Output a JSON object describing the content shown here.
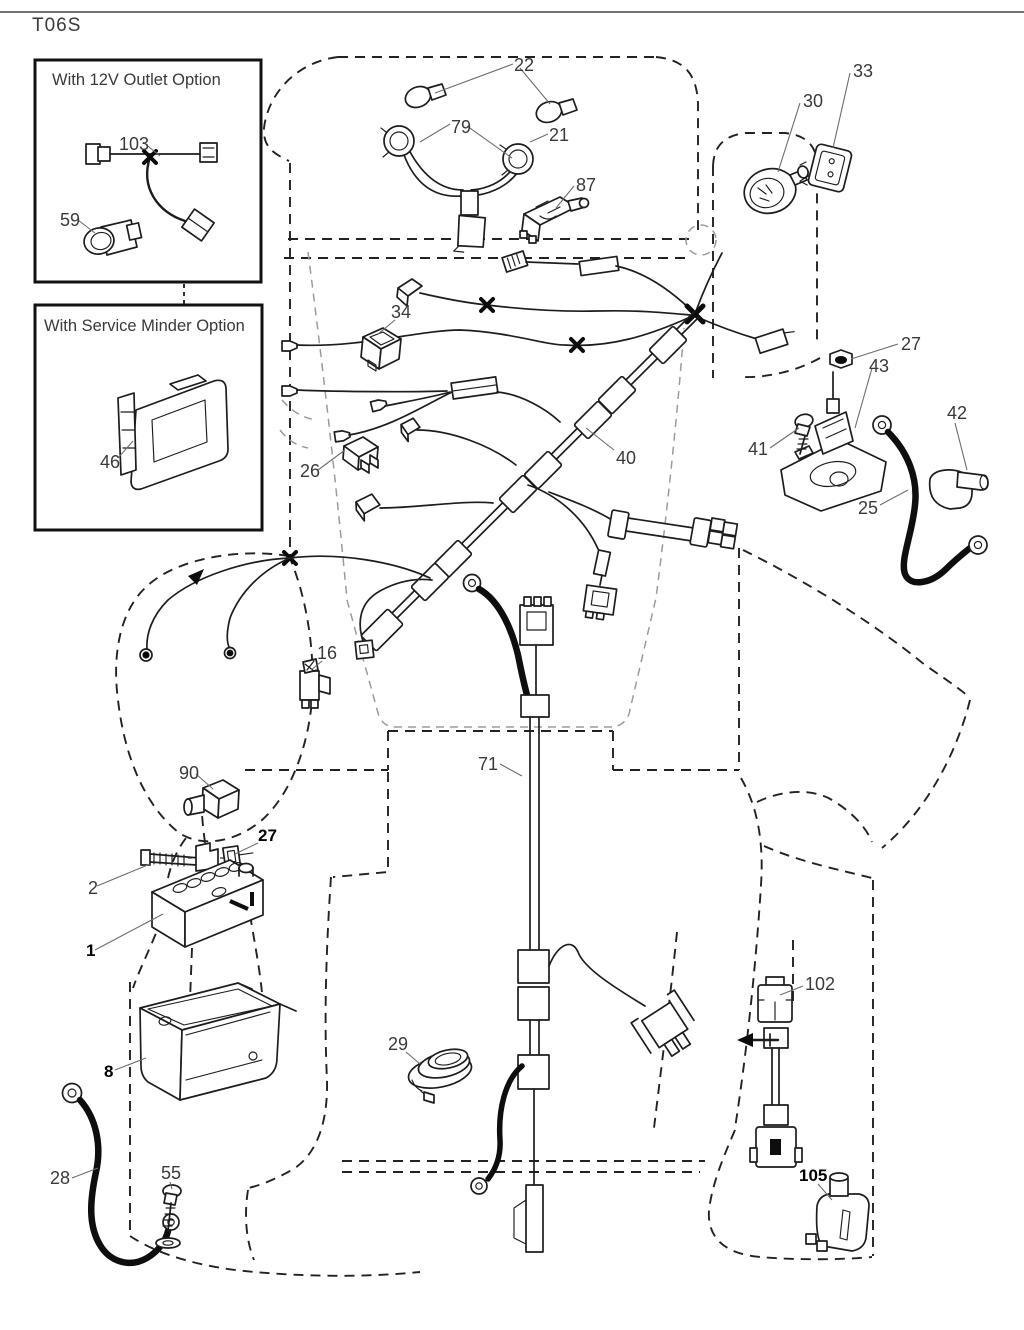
{
  "page": {
    "code": "T06S"
  },
  "insets": [
    {
      "id": "12v-outlet",
      "title": "With 12V Outlet Option"
    },
    {
      "id": "service-minder",
      "title": "With Service Minder Option"
    }
  ],
  "colors": {
    "line": "#1d1d1d",
    "cable": "#0e0e0e",
    "gray_dash": "#9b9b9b",
    "label": "#3a3a3a"
  },
  "labels": [
    {
      "id": "doc-code",
      "text": "T06S",
      "x": 32,
      "y": 31,
      "size": 19,
      "ls": 1
    },
    {
      "id": "inset-12v-title",
      "text": "With 12V Outlet Option",
      "x": 52,
      "y": 85,
      "size": 16.5
    },
    {
      "id": "103",
      "text": "103",
      "x": 119,
      "y": 150
    },
    {
      "id": "59",
      "text": "59",
      "x": 60,
      "y": 226
    },
    {
      "id": "inset-sm-title",
      "text": "With Service Minder Option",
      "x": 44,
      "y": 331,
      "size": 16.5
    },
    {
      "id": "46",
      "text": "46",
      "x": 100,
      "y": 468
    },
    {
      "id": "22",
      "text": "22",
      "x": 514,
      "y": 71
    },
    {
      "id": "79",
      "text": "79",
      "x": 451,
      "y": 133
    },
    {
      "id": "21",
      "text": "21",
      "x": 549,
      "y": 141
    },
    {
      "id": "87",
      "text": "87",
      "x": 576,
      "y": 191
    },
    {
      "id": "30",
      "text": "30",
      "x": 803,
      "y": 107
    },
    {
      "id": "33",
      "text": "33",
      "x": 853,
      "y": 77
    },
    {
      "id": "27a",
      "text": "27",
      "x": 901,
      "y": 350
    },
    {
      "id": "43",
      "text": "43",
      "x": 869,
      "y": 372
    },
    {
      "id": "41",
      "text": "41",
      "x": 748,
      "y": 455
    },
    {
      "id": "42",
      "text": "42",
      "x": 947,
      "y": 419
    },
    {
      "id": "25",
      "text": "25",
      "x": 858,
      "y": 514
    },
    {
      "id": "34",
      "text": "34",
      "x": 391,
      "y": 318
    },
    {
      "id": "40",
      "text": "40",
      "x": 616,
      "y": 464
    },
    {
      "id": "26",
      "text": "26",
      "x": 300,
      "y": 477
    },
    {
      "id": "16",
      "text": "16",
      "x": 317,
      "y": 659
    },
    {
      "id": "90",
      "text": "90",
      "x": 179,
      "y": 779
    },
    {
      "id": "27b",
      "text": "27",
      "x": 258,
      "y": 841,
      "size": 17,
      "bold": true
    },
    {
      "id": "2",
      "text": "2",
      "x": 88,
      "y": 894
    },
    {
      "id": "1",
      "text": "1",
      "x": 86,
      "y": 956,
      "size": 17,
      "bold": true
    },
    {
      "id": "8",
      "text": "8",
      "x": 104,
      "y": 1077,
      "size": 17,
      "bold": true
    },
    {
      "id": "28",
      "text": "28",
      "x": 50,
      "y": 1184
    },
    {
      "id": "55",
      "text": "55",
      "x": 161,
      "y": 1179
    },
    {
      "id": "29",
      "text": "29",
      "x": 388,
      "y": 1050
    },
    {
      "id": "71",
      "text": "71",
      "x": 478,
      "y": 770
    },
    {
      "id": "102",
      "text": "102",
      "x": 805,
      "y": 990
    },
    {
      "id": "105",
      "text": "105",
      "x": 799,
      "y": 1181,
      "size": 17,
      "bold": true
    }
  ]
}
